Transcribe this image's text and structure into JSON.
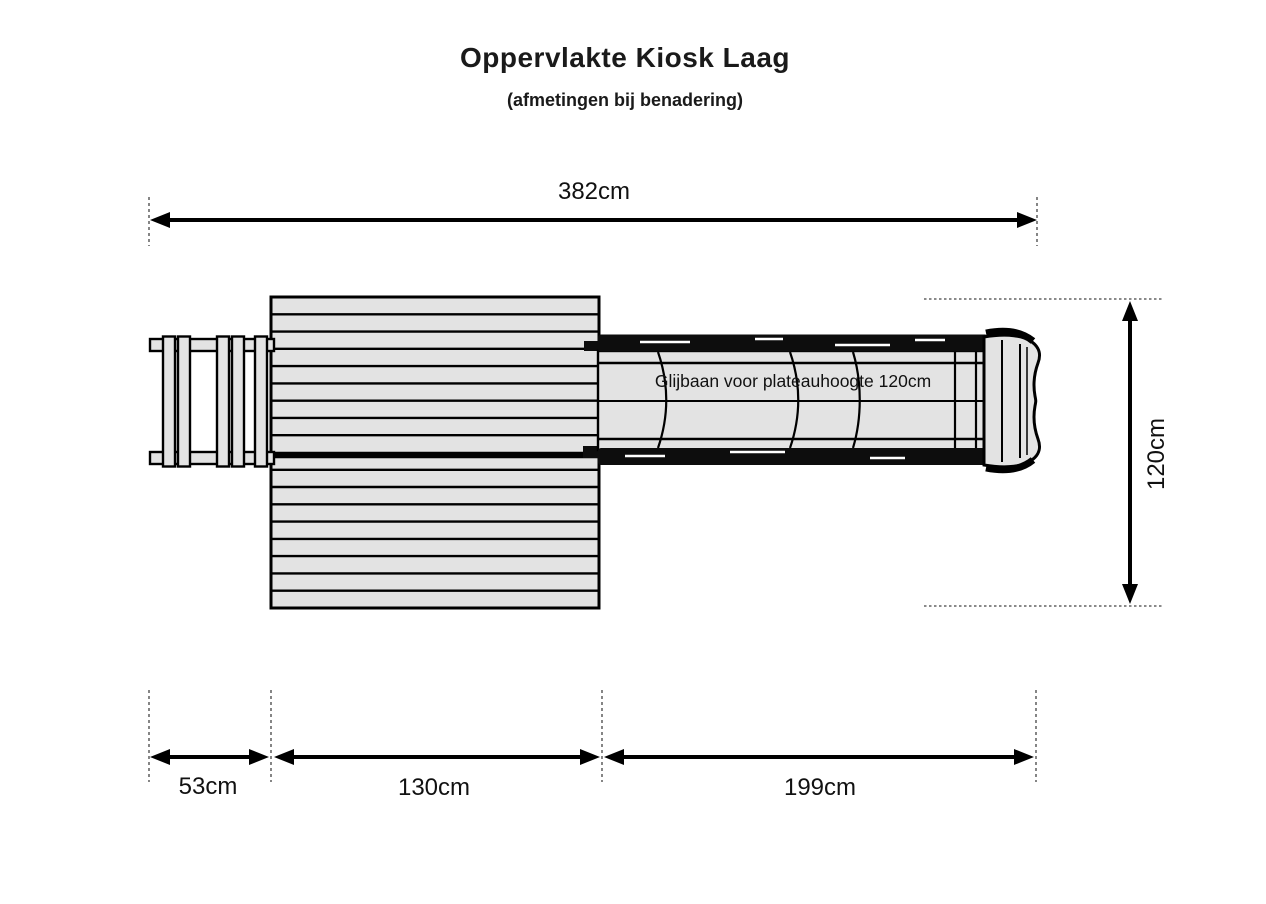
{
  "header": {
    "title": "Oppervlakte Kiosk Laag",
    "subtitle": "(afmetingen bij benadering)"
  },
  "drawing": {
    "slide_label": "Glijbaan voor plateauhoogte 120cm"
  },
  "dimensions": {
    "total_width": {
      "label": "382cm"
    },
    "depth": {
      "label": "120cm"
    },
    "ladder": {
      "label": "53cm"
    },
    "platform": {
      "label": "130cm"
    },
    "slide": {
      "label": "199cm"
    }
  },
  "colors": {
    "background": "#ffffff",
    "outline": "#000000",
    "fill_light": "#e3e3e3",
    "rail_dark": "#0d0d0d",
    "text": "#1a1a1a",
    "extension_line": "#444444"
  }
}
